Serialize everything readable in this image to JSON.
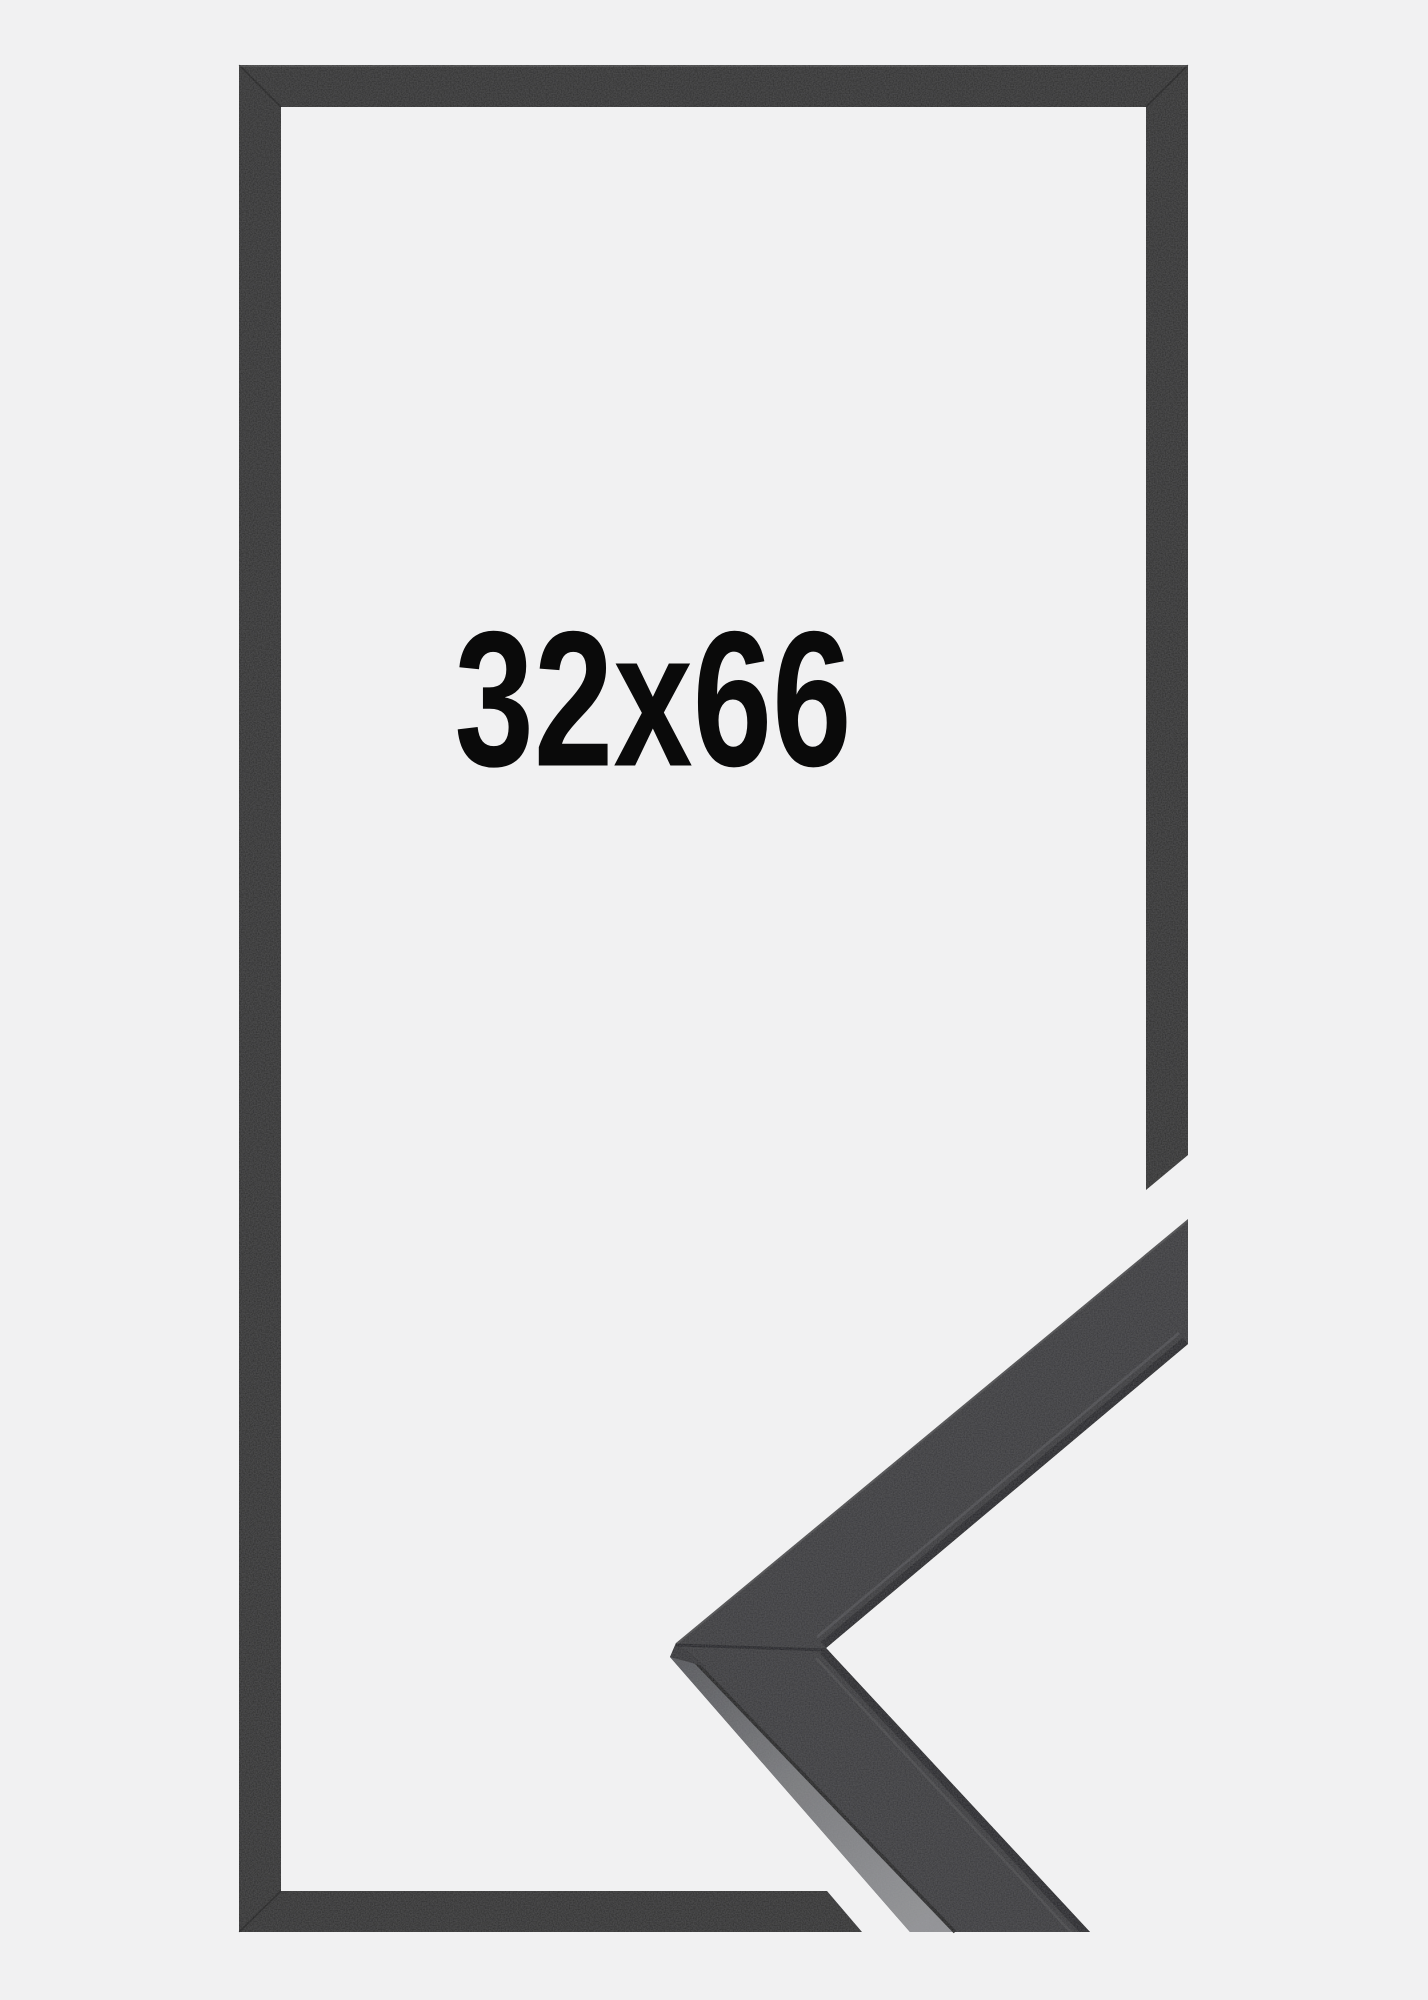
{
  "meta": {
    "description": "Product image of a black picture frame shown face-on with a 3D mitred-corner moulding sample overlapping the lower right side",
    "background_color": "#f1f1f2"
  },
  "frame": {
    "size_label": "32x66",
    "label_color": "#0a0a0a",
    "frame_color": "#2d2d2f",
    "corner_sample": {
      "face_color": "#39393b",
      "edge_band_light": "#909194",
      "edge_band_dark": "#55565a",
      "crease_color": "#1d1d1f"
    }
  }
}
